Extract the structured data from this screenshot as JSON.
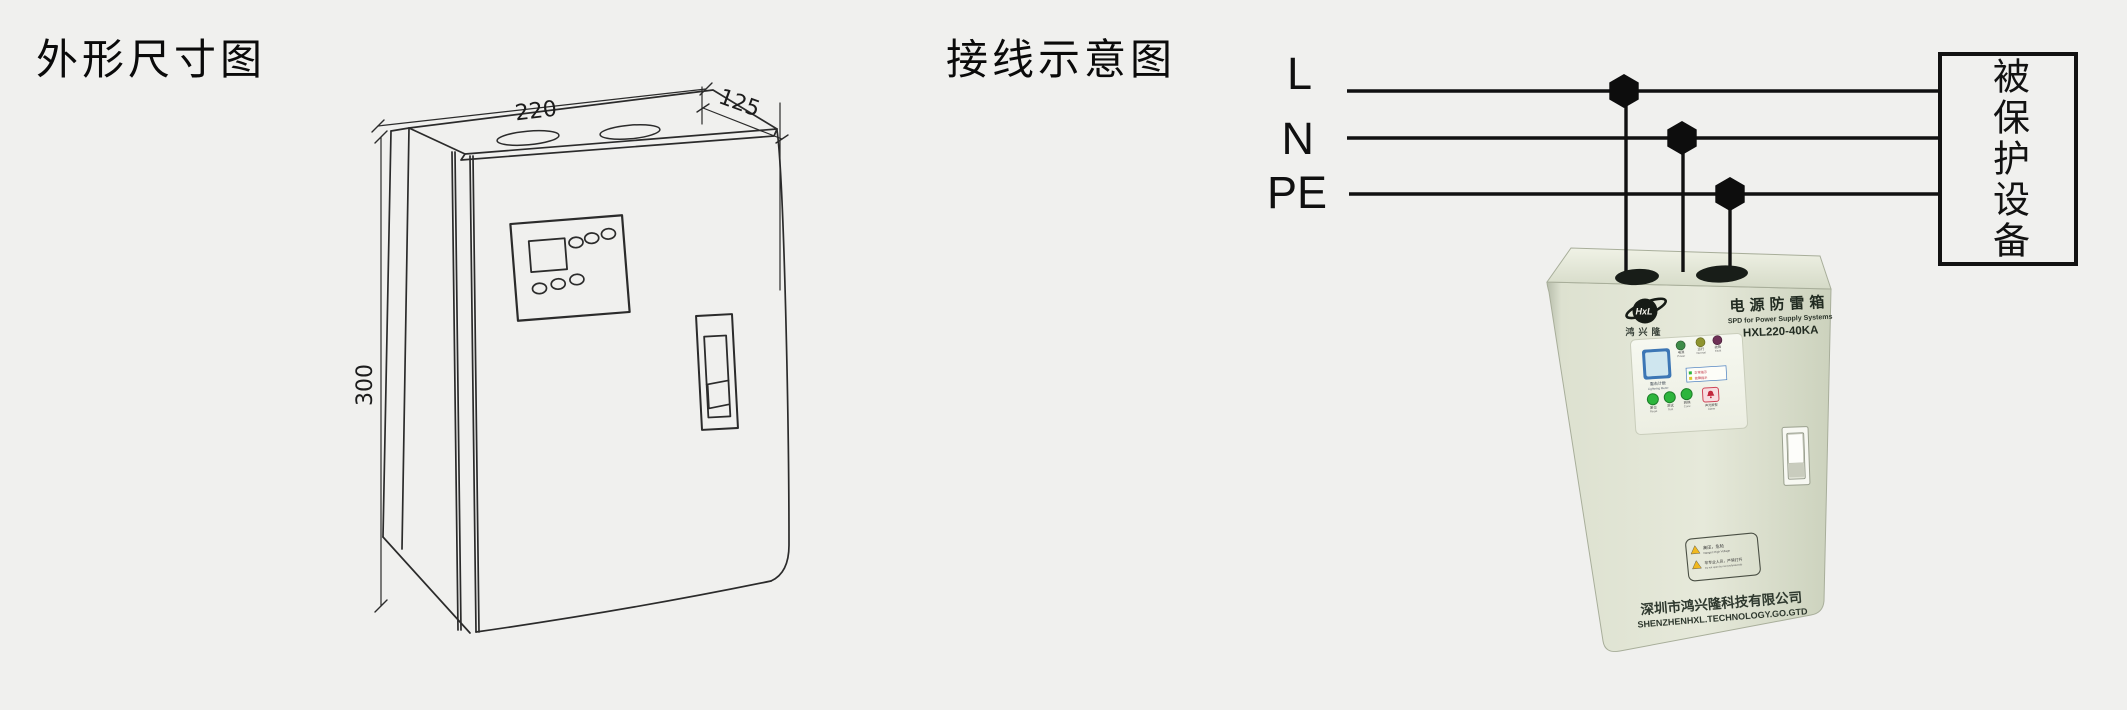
{
  "page": {
    "background": "#f0f0ee"
  },
  "outline_drawing": {
    "title": "外形尺寸图",
    "dim_width": "220",
    "dim_depth": "125",
    "dim_height": "300"
  },
  "wiring": {
    "title": "接线示意图",
    "wire_labels": [
      "L",
      "N",
      "PE"
    ],
    "protected_device": "被保护设备",
    "wire_color": "#111111"
  },
  "device": {
    "body_color": "#dde1d0",
    "logo": "HxL",
    "brand": "鸿兴隆",
    "name": "电源防雷箱",
    "subtitle": "SPD for Power Supply Systems",
    "model": "HXL220-40KA",
    "panel": {
      "counter_cn": "雷击计数",
      "counter_en": "Lightning Meter",
      "leds": [
        {
          "cn": "电源",
          "en": "Power",
          "color": "#3e8c48"
        },
        {
          "cn": "运行",
          "en": "Normal",
          "color": "#8f9430"
        },
        {
          "cn": "故障",
          "en": "Fault",
          "color": "#6e3156"
        }
      ],
      "legend": [
        {
          "color": "#2db53c",
          "text": "正常指示"
        },
        {
          "color": "#ddc52d",
          "text": "故障指示"
        }
      ],
      "buttons": [
        {
          "cn": "复位",
          "en": "Reset"
        },
        {
          "cn": "测试",
          "en": "Test"
        },
        {
          "cn": "转换",
          "en": "Conv."
        }
      ],
      "alarm_cn": "声光报警",
      "alarm_en": "Alarm"
    },
    "warning": {
      "row1_cn": "高压，危险",
      "row1_en": "Danger! High Voltage",
      "row2_cn": "非专业人员，严禁打开",
      "row2_en": "Do not open by non-professionals"
    },
    "company_cn": "深圳市鸿兴隆科技有限公司",
    "company_en": "SHENZHENHXL.TECHNOLOGY.GO.GTD"
  }
}
